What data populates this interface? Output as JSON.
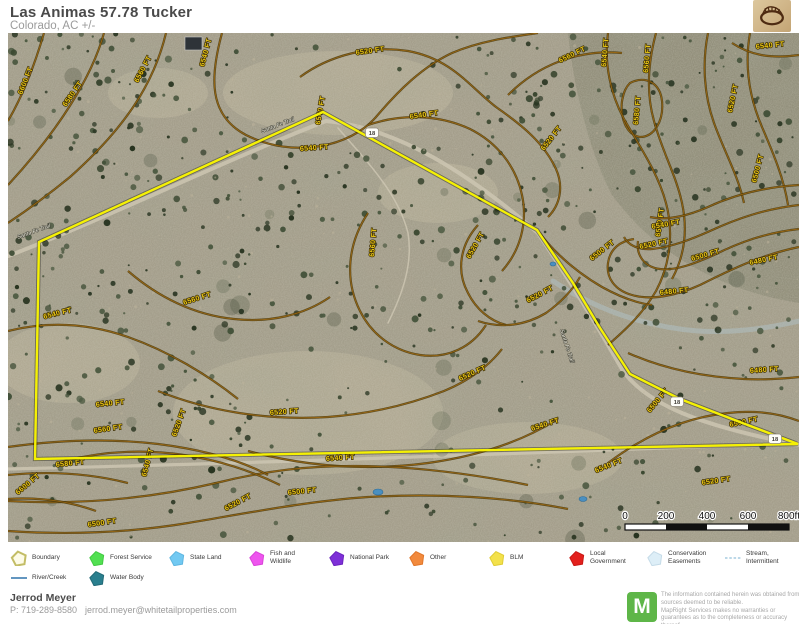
{
  "header": {
    "title": "Las Animas 57.78 Tucker",
    "subtitle": "Colorado,  AC +/-"
  },
  "map": {
    "palette": {
      "ground": "#a39d8a",
      "ground_light": "#bcb29a",
      "canyon_shade": "rgba(108,112,90,0.30)",
      "contour_casing": "#4a3808",
      "contour_core": "#a06a14",
      "contour_label": "#e9c615",
      "boundary": "#f5f104",
      "road": "#cdc6b2",
      "water": "#4a8fc0",
      "wash": "#aebfc2",
      "trees": [
        "#2f3a27",
        "#3a4730",
        "#44523a",
        "#27331f",
        "#4d5a42"
      ]
    },
    "boundary_points": "315,79 31,209 27,426 790,411 737,391 672,366 622,341 592,295 565,250 529,197",
    "roads": [
      {
        "d": "M-5,225 C100,185 210,130 318,88 C390,95 460,140 530,200 C560,245 585,285 615,338 C640,372 690,392 791,412",
        "w": 4
      },
      {
        "d": "M0,436 C260,430 520,420 791,410",
        "w": 3.2
      },
      {
        "d": "M330,95 C360,130 390,160 400,200 C405,230 395,260 380,290",
        "w": 1.5
      }
    ],
    "road_labels": [
      {
        "t": "Santa Fe Trail",
        "x": 10,
        "y": 206,
        "a": -20
      },
      {
        "t": "Santa Fe Trail",
        "x": 254,
        "y": 100,
        "a": -21
      },
      {
        "t": "Santa Fe Trail",
        "x": 552,
        "y": 297,
        "a": 72
      }
    ],
    "shields": [
      {
        "t": "18",
        "x": 364,
        "y": 100
      },
      {
        "t": "18",
        "x": 669,
        "y": 369
      },
      {
        "t": "18",
        "x": 767,
        "y": 406
      }
    ],
    "ponds": [
      {
        "x": 370,
        "y": 459,
        "rx": 5,
        "ry": 3
      },
      {
        "x": 575,
        "y": 466,
        "rx": 4,
        "ry": 2.5
      },
      {
        "x": 545,
        "y": 231,
        "rx": 3,
        "ry": 2
      }
    ],
    "washes": [
      {
        "d": "M545,248 C590,278 640,294 690,298 C724,300 756,296 791,288",
        "w": 5
      }
    ],
    "building": {
      "x": 177,
      "y": 4,
      "w": 17,
      "h": 13
    },
    "contours": [
      {
        "d": "M36,0 C26,34 14,64 0,88",
        "labels": [
          {
            "t": "6600 FT",
            "x": 14,
            "y": 62,
            "a": -68
          }
        ]
      },
      {
        "d": "M96,0 C84,44 50,98 0,152",
        "labels": [
          {
            "t": "6580 FT",
            "x": 58,
            "y": 74,
            "a": -55
          }
        ]
      },
      {
        "d": "M158,0 C146,50 118,94 62,144 C40,162 18,178 0,190",
        "labels": [
          {
            "t": "6560 FT",
            "x": 130,
            "y": 50,
            "a": -62
          }
        ]
      },
      {
        "d": "M214,0 C202,44 200,82 238,102 C286,126 342,114 368,84 C390,58 414,34 444,20 C472,8 502,4 530,0",
        "labels": [
          {
            "t": "6540 FT",
            "x": 196,
            "y": 34,
            "a": -75
          },
          {
            "t": "6540 FT",
            "x": 292,
            "y": 118,
            "a": -4
          }
        ]
      },
      {
        "d": "M292,44 C322,22 362,12 400,18 C444,26 462,54 488,74 C514,92 536,110 548,136 C556,154 552,172 540,184",
        "labels": [
          {
            "t": "6520 FT",
            "x": 348,
            "y": 22,
            "a": -8
          },
          {
            "t": "6520 FT",
            "x": 536,
            "y": 118,
            "a": -52
          }
        ]
      },
      {
        "d": "M500,62 C530,32 570,16 614,20",
        "labels": [
          {
            "t": "6560 FT",
            "x": 552,
            "y": 30,
            "a": -26
          }
        ]
      },
      {
        "d": "M622,50 C638,42 652,50 654,68 C656,88 646,104 632,104 C618,102 612,84 614,68 C616,58 618,54 622,50 Z",
        "labels": [
          {
            "t": "6580 FT",
            "x": 630,
            "y": 92,
            "a": -85
          }
        ]
      },
      {
        "d": "M648,0 C640,30 638,60 646,88 C654,118 668,142 674,170 C680,198 676,224 664,246",
        "labels": [
          {
            "t": "6560 FT",
            "x": 640,
            "y": 40,
            "a": -85
          }
        ]
      },
      {
        "d": "M600,0 C596,30 602,60 616,86 C632,114 650,140 658,170 C666,200 662,232 648,258 C634,282 616,298 600,312",
        "labels": [
          {
            "t": "6540 FT",
            "x": 598,
            "y": 34,
            "a": -85
          },
          {
            "t": "6540 FT",
            "x": 652,
            "y": 204,
            "a": -82
          }
        ]
      },
      {
        "d": "M700,0 C694,30 696,62 706,90 C716,118 730,142 736,170",
        "labels": [
          {
            "t": "6520 FT",
            "x": 724,
            "y": 80,
            "a": -78
          }
        ]
      },
      {
        "d": "M742,0 C736,34 742,66 754,94 C766,122 776,146 780,172",
        "labels": [
          {
            "t": "6500 FT",
            "x": 748,
            "y": 150,
            "a": -75
          }
        ]
      },
      {
        "d": "M791,22 C762,26 742,22 724,10",
        "labels": [
          {
            "t": "6540 FT",
            "x": 748,
            "y": 16,
            "a": -6
          }
        ]
      },
      {
        "d": "M791,214 C752,222 720,238 692,252 C670,262 644,268 624,262 C606,257 598,244 600,230 C602,216 612,208 626,206",
        "labels": [
          {
            "t": "6480 FT",
            "x": 742,
            "y": 232,
            "a": -12
          },
          {
            "t": "6480 FT",
            "x": 652,
            "y": 262,
            "a": -6
          }
        ]
      },
      {
        "d": "M791,196 C756,200 730,210 706,222 C688,230 668,238 652,236 C636,234 628,222 630,208",
        "labels": [
          {
            "t": "6500 FT",
            "x": 684,
            "y": 228,
            "a": -16
          }
        ]
      },
      {
        "d": "M791,172 C756,176 728,186 702,198 C684,206 664,214 644,216 C630,217 620,212 616,204",
        "labels": [
          {
            "t": "6520 FT",
            "x": 632,
            "y": 216,
            "a": -12
          }
        ]
      },
      {
        "d": "M791,152 C756,154 726,162 700,174 C682,182 660,188 642,184",
        "labels": [
          {
            "t": "6540 FT",
            "x": 644,
            "y": 196,
            "a": -10
          }
        ]
      },
      {
        "d": "M470,192 C452,212 448,238 460,260 C468,276 482,288 498,292",
        "labels": [
          {
            "t": "6520 FT",
            "x": 462,
            "y": 226,
            "a": -60
          }
        ]
      },
      {
        "d": "M470,288 C494,296 518,292 538,280 C552,270 564,258 572,244",
        "labels": [
          {
            "t": "6520 FT",
            "x": 520,
            "y": 270,
            "a": -28
          }
        ]
      },
      {
        "d": "M530,198 C548,222 570,240 594,254 C612,264 628,270 644,272",
        "labels": [
          {
            "t": "6500 FT",
            "x": 584,
            "y": 228,
            "a": -38
          }
        ]
      },
      {
        "d": "M360,180 C340,210 336,246 352,278 C364,302 386,318 412,322 C440,326 464,314 478,292",
        "labels": [
          {
            "t": "6560 FT",
            "x": 366,
            "y": 224,
            "a": -85
          }
        ]
      },
      {
        "d": "M120,238 C150,264 186,282 226,286 C262,290 296,282 322,264",
        "labels": [
          {
            "t": "6560 FT",
            "x": 176,
            "y": 272,
            "a": -18
          }
        ]
      },
      {
        "d": "M360,92 C395,80 432,82 462,96 C490,110 508,134 514,162 C520,190 512,218 494,238",
        "labels": [
          {
            "t": "6540 FT",
            "x": 402,
            "y": 86,
            "a": -8
          }
        ]
      },
      {
        "d": "M150,358 C200,378 260,388 320,384 C360,381 400,372 436,358 C460,348 480,334 494,316",
        "labels": [
          {
            "t": "6520 FT",
            "x": 262,
            "y": 382,
            "a": -4
          },
          {
            "t": "6520 FT",
            "x": 452,
            "y": 348,
            "a": -24
          }
        ]
      },
      {
        "d": "M240,418 C300,434 360,438 420,430 C470,423 515,408 550,386",
        "labels": [
          {
            "t": "6540 FT",
            "x": 318,
            "y": 428,
            "a": -4
          },
          {
            "t": "6540 FT",
            "x": 524,
            "y": 398,
            "a": -18
          }
        ]
      },
      {
        "d": "M0,498 C60,502 120,500 180,490 C240,480 300,468 360,464 C430,460 500,464 560,476",
        "labels": [
          {
            "t": "6500 FT",
            "x": 280,
            "y": 462,
            "a": -6
          },
          {
            "t": "6500 FT",
            "x": 80,
            "y": 494,
            "a": -8
          }
        ]
      },
      {
        "d": "M0,468 C70,472 140,466 208,450 C240,442 274,436 310,434 C380,430 450,438 520,452",
        "labels": [
          {
            "t": "6520 FT",
            "x": 168,
            "y": 404,
            "a": -70
          },
          {
            "t": "6520 FT",
            "x": 218,
            "y": 478,
            "a": -28
          },
          {
            "t": "6520 FT",
            "x": 694,
            "y": 452,
            "a": -8
          }
        ]
      },
      {
        "d": "M56,428 C96,418 136,416 176,422 C210,427 244,438 272,452",
        "labels": [
          {
            "t": "6540 FT",
            "x": 88,
            "y": 374,
            "a": -6
          },
          {
            "t": "6540 FT",
            "x": 138,
            "y": 444,
            "a": -75
          },
          {
            "t": "6540 FT",
            "x": 588,
            "y": 440,
            "a": -22
          }
        ]
      },
      {
        "d": "M0,414 C50,407 100,405 150,411 C190,416 230,426 260,442",
        "labels": [
          {
            "t": "6560 FT",
            "x": 86,
            "y": 400,
            "a": -8
          }
        ]
      },
      {
        "d": "M0,442 C40,438 80,440 120,450",
        "labels": [
          {
            "t": "6580 FT",
            "x": 48,
            "y": 434,
            "a": -6
          }
        ]
      },
      {
        "d": "M0,466 C30,464 60,468 88,478",
        "labels": [
          {
            "t": "6600 FT",
            "x": 10,
            "y": 462,
            "a": -40
          }
        ]
      },
      {
        "d": "M0,298 C40,288 80,290 120,304 C160,318 200,342 230,366",
        "labels": [
          {
            "t": "6540 FT",
            "x": 36,
            "y": 286,
            "a": -14
          }
        ]
      },
      {
        "d": "M620,320 C656,336 696,344 736,346 C754,347 772,346 791,344",
        "labels": [
          {
            "t": "6480 FT",
            "x": 742,
            "y": 340,
            "a": -4
          }
        ]
      },
      {
        "d": "M600,430 C640,400 680,384 720,380 C746,377 770,380 791,388",
        "labels": [
          {
            "t": "6500 FT",
            "x": 642,
            "y": 380,
            "a": -50
          },
          {
            "t": "6500 FT",
            "x": 722,
            "y": 394,
            "a": -12
          }
        ]
      },
      {
        "d": "",
        "labels": [
          {
            "t": "6540 FT",
            "x": 312,
            "y": 92,
            "a": -80
          }
        ]
      }
    ],
    "scale_bar": {
      "labels": [
        "0",
        "200",
        "400",
        "600",
        "800ft"
      ],
      "x": 617,
      "y": 478,
      "segment_px": 41,
      "segments": 4
    }
  },
  "legend": {
    "items": [
      {
        "key": "boundary",
        "label": "Boundary",
        "type": "pentagon",
        "fill": "#fdfbe7",
        "stroke": "#c3bd66",
        "x": 10,
        "row": 1
      },
      {
        "key": "forest-service",
        "label": "Forest Service",
        "type": "pentagon",
        "fill": "#52e052",
        "stroke": "#43c943",
        "x": 88,
        "row": 1
      },
      {
        "key": "state-land",
        "label": "State Land",
        "type": "pentagon",
        "fill": "#72c9f2",
        "stroke": "#5fb6e0",
        "x": 168,
        "row": 1
      },
      {
        "key": "fish-and-wildlife",
        "label": "Fish and\nWildlife",
        "type": "pentagon",
        "fill": "#ee55ee",
        "stroke": "#d944d9",
        "x": 248,
        "row": 1
      },
      {
        "key": "national-park",
        "label": "National Park",
        "type": "pentagon",
        "fill": "#7e30d8",
        "stroke": "#6b24be",
        "x": 328,
        "row": 1
      },
      {
        "key": "other",
        "label": "Other",
        "type": "pentagon",
        "fill": "#f28a3d",
        "stroke": "#e0762a",
        "x": 408,
        "row": 1
      },
      {
        "key": "blm",
        "label": "BLM",
        "type": "pentagon",
        "fill": "#f3e14b",
        "stroke": "#dfcc35",
        "x": 488,
        "row": 1
      },
      {
        "key": "local-government",
        "label": "Local\nGovernment",
        "type": "pentagon",
        "fill": "#e3201d",
        "stroke": "#c81815",
        "x": 568,
        "row": 1
      },
      {
        "key": "conservation-easements",
        "label": "Conservation\nEasements",
        "type": "pentagon",
        "fill": "#ddeef7",
        "stroke": "#c5dbe8",
        "x": 646,
        "row": 1
      },
      {
        "key": "stream-intermittent",
        "label": "Stream,\nIntermittent",
        "type": "dashed-line",
        "stroke": "#a6cbe0",
        "x": 724,
        "row": 1
      },
      {
        "key": "river-creek",
        "label": "River/Creek",
        "type": "line",
        "stroke": "#3c7cb0",
        "x": 10,
        "row": 2
      },
      {
        "key": "water-body",
        "label": "Water Body",
        "type": "pentagon",
        "fill": "#2a7f8e",
        "stroke": "#226a77",
        "x": 88,
        "row": 2
      }
    ]
  },
  "footer": {
    "agent_name": "Jerrod Meyer",
    "phone": "P: 719-289-8580",
    "email": "jerrod.meyer@whitetailproperties.com",
    "mapright_initial": "M",
    "disclaimer_line1": "The information contained herein was obtained from sources deemed to be reliable.",
    "disclaimer_line2": "  MapRight Services makes no warranties or guarantees as to the completeness or accuracy thereof."
  }
}
